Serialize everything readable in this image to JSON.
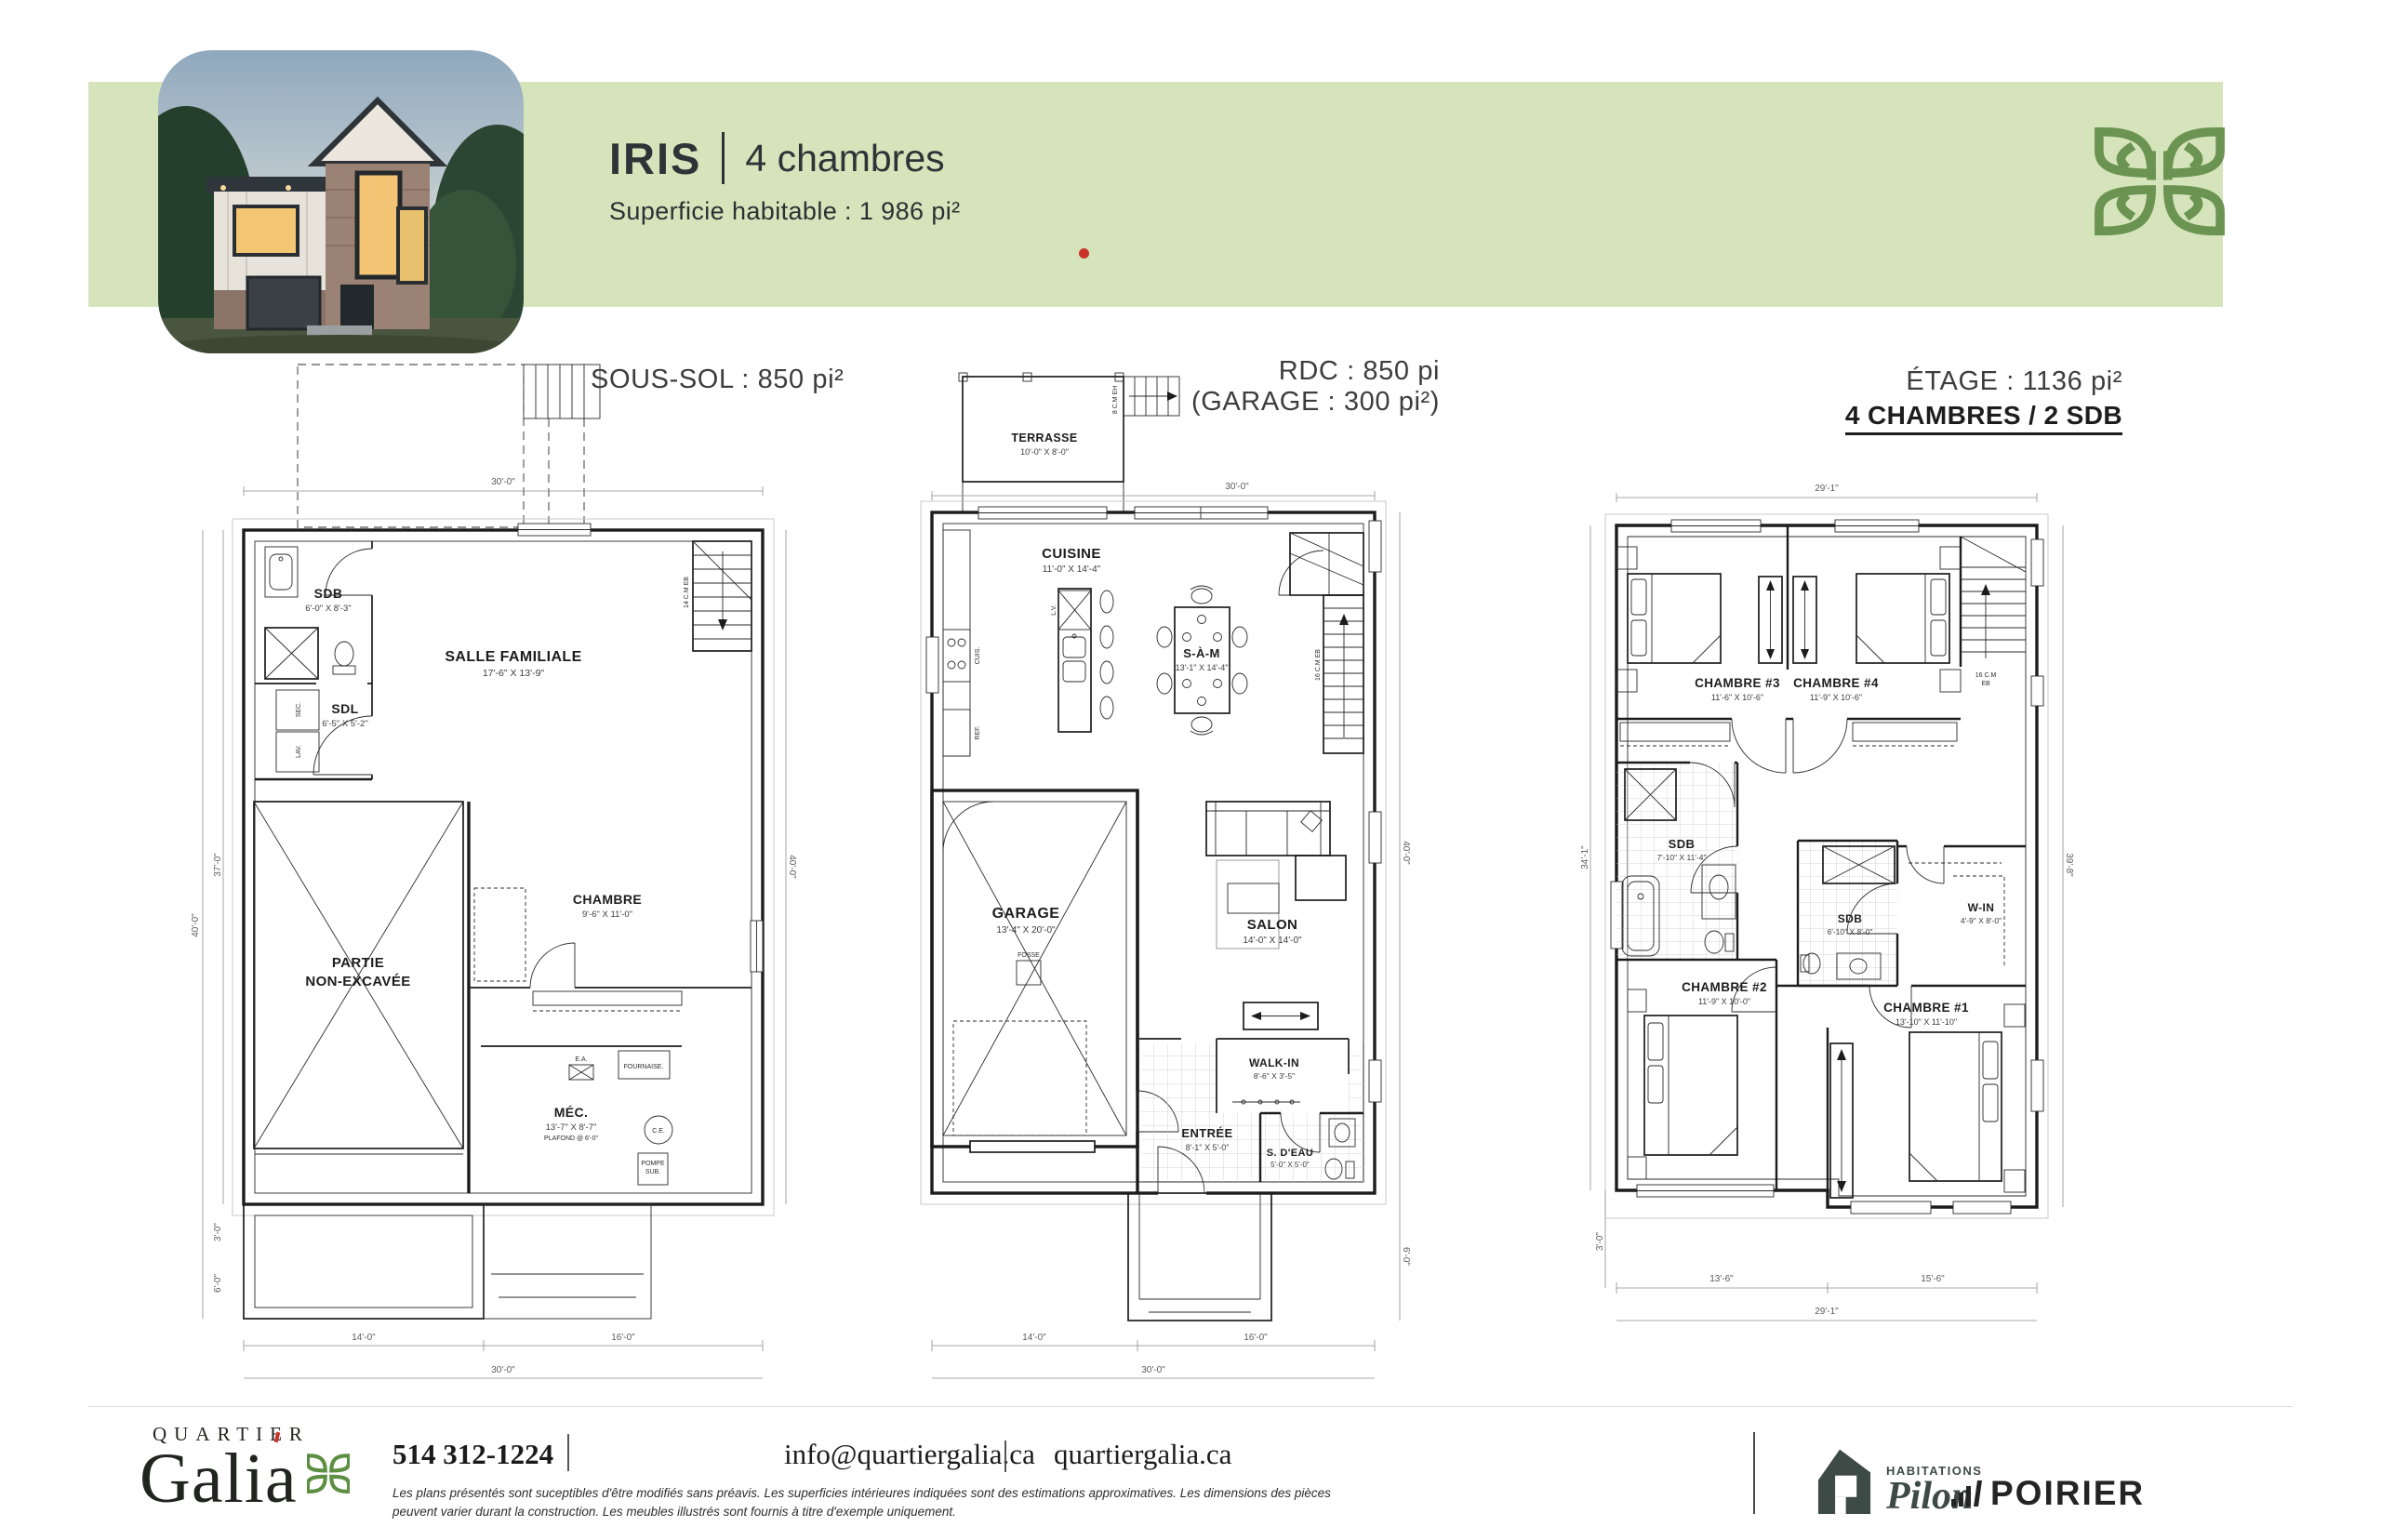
{
  "header": {
    "band_color": "#d6e4bb",
    "title": "IRIS",
    "divider": "|",
    "subtitle": "4 chambres",
    "area": "Superficie habitable : 1 986 pi²",
    "accent_red": "#c8322b",
    "logo_green": "#6b9351"
  },
  "plans": {
    "sous_sol": {
      "title": "SOUS-SOL : 850 pi²",
      "rooms": {
        "sdb": {
          "name": "SDB",
          "dims": "6'-0\" X 8'-3\""
        },
        "sdl": {
          "name": "SDL",
          "dims": "6'-5\" X 5'-2\""
        },
        "salle_familiale": {
          "name": "SALLE FAMILIALE",
          "dims": "17'-6\" X 13'-9\""
        },
        "partie": {
          "line1": "PARTIE",
          "line2": "NON-EXCAVÉE"
        },
        "chambre": {
          "name": "CHAMBRE",
          "dims": "9'-6\" X 11'-0\""
        },
        "mec": {
          "name": "MÉC.",
          "dims": "13'-7\" X 8'-7\"",
          "note": "PLAFOND @ 6'-0\""
        }
      },
      "fixtures": {
        "sec": "SEC.",
        "lav": "LAV.",
        "ea": "E.A.",
        "fournaise": "FOURNAISE.",
        "ce": "C.E.",
        "pompe1": "POMPE",
        "pompe2": "SUB.",
        "stairs": "14 C.M EB"
      },
      "dims": {
        "top": "30'-0\"",
        "left_outer": "40'-0\"",
        "left_inner": "37'-0\"",
        "left_a": "3'-0\"",
        "left_b": "6'-0\"",
        "right": "40'-0\"",
        "bottom_left": "14'-0\"",
        "bottom_right": "16'-0\"",
        "bottom_total": "30'-0\""
      }
    },
    "rdc": {
      "title_line1": "RDC : 850 pi",
      "title_line2": "(GARAGE : 300 pi²)",
      "rooms": {
        "terrasse": {
          "name": "TERRASSE",
          "dims": "10'-0\" X 8'-0\""
        },
        "cuisine": {
          "name": "CUISINE",
          "dims": "11'-0\" X 14'-4\""
        },
        "sam": {
          "name": "S-À-M",
          "dims": "13'-1\" X 14'-4\""
        },
        "garage": {
          "name": "GARAGE",
          "dims": "13'-4\" X 20'-0\""
        },
        "salon": {
          "name": "SALON",
          "dims": "14'-0\" X 14'-0\""
        },
        "walkin": {
          "name": "WALK-IN",
          "dims": "8'-6\" X 3'-5\""
        },
        "entree": {
          "name": "ENTRÉE",
          "dims": "8'-1\" X 5'-0\""
        },
        "sdeau": {
          "name": "S. D'EAU",
          "dims": "5'-0\" X 5'-0\""
        }
      },
      "fixtures": {
        "fosse": "FOSSE",
        "lv": "L.V.",
        "cuis": "CUIS.",
        "ref": "REF.",
        "terrace_stairs": "8 C.M EH",
        "stairs": "16 C.M EB"
      },
      "dims": {
        "top": "30'-0\"",
        "right": "40'-0\"",
        "right_b": "6'-0\"",
        "bottom_left": "14'-0\"",
        "bottom_right": "16'-0\"",
        "bottom_total": "30'-0\""
      }
    },
    "etage": {
      "title_line1": "ÉTAGE : 1136 pi²",
      "title_line2": "4 CHAMBRES / 2 SDB",
      "rooms": {
        "chambre3": {
          "name": "CHAMBRE #3",
          "dims": "11'-6\" X 10'-6\""
        },
        "chambre4": {
          "name": "CHAMBRE #4",
          "dims": "11'-9\" X 10'-6\""
        },
        "sdb1": {
          "name": "SDB",
          "dims": "7'-10\" X 11'-4\""
        },
        "sdb2": {
          "name": "SDB",
          "dims": "6'-10\" X 8'-0\""
        },
        "win": {
          "name": "W-IN",
          "dims": "4'-9\" X 8'-0\""
        },
        "chambre2": {
          "name": "CHAMBRE #2",
          "dims": "11'-9\" X 10'-0\""
        },
        "chambre1": {
          "name": "CHAMBRE #1",
          "dims": "13'-10\" X 11'-10\""
        }
      },
      "fixtures": {
        "stairs1": "16 C.M",
        "stairs2": "EB"
      },
      "dims": {
        "top": "29'-1\"",
        "left": "34'-1\"",
        "left_b": "3'-0\"",
        "right": "39'-8\"",
        "bottom_left": "13'-6\"",
        "bottom_right": "15'-6\"",
        "bottom_total": "29'-1\""
      }
    }
  },
  "footer": {
    "brand_top": "QUARTIER",
    "brand_name": "Galia",
    "phone": "514 312-1224",
    "separator": "|",
    "email": "info@quartiergalia.ca",
    "website": "quartiergalia.ca",
    "disclaimer_line1": "Les plans présentés sont suceptibles d'être modifiés sans préavis. Les superficies intérieures indiquées sont des estimations approximatives. Les dimensions des pièces",
    "disclaimer_line2": "peuvent varier durant la construction. Les meubles illustrés sont fournis à titre d'exemple uniquement.",
    "partner1_label": "HABITATIONS",
    "partner1_name": "Pilon",
    "partner2_name": "POIRIER"
  }
}
